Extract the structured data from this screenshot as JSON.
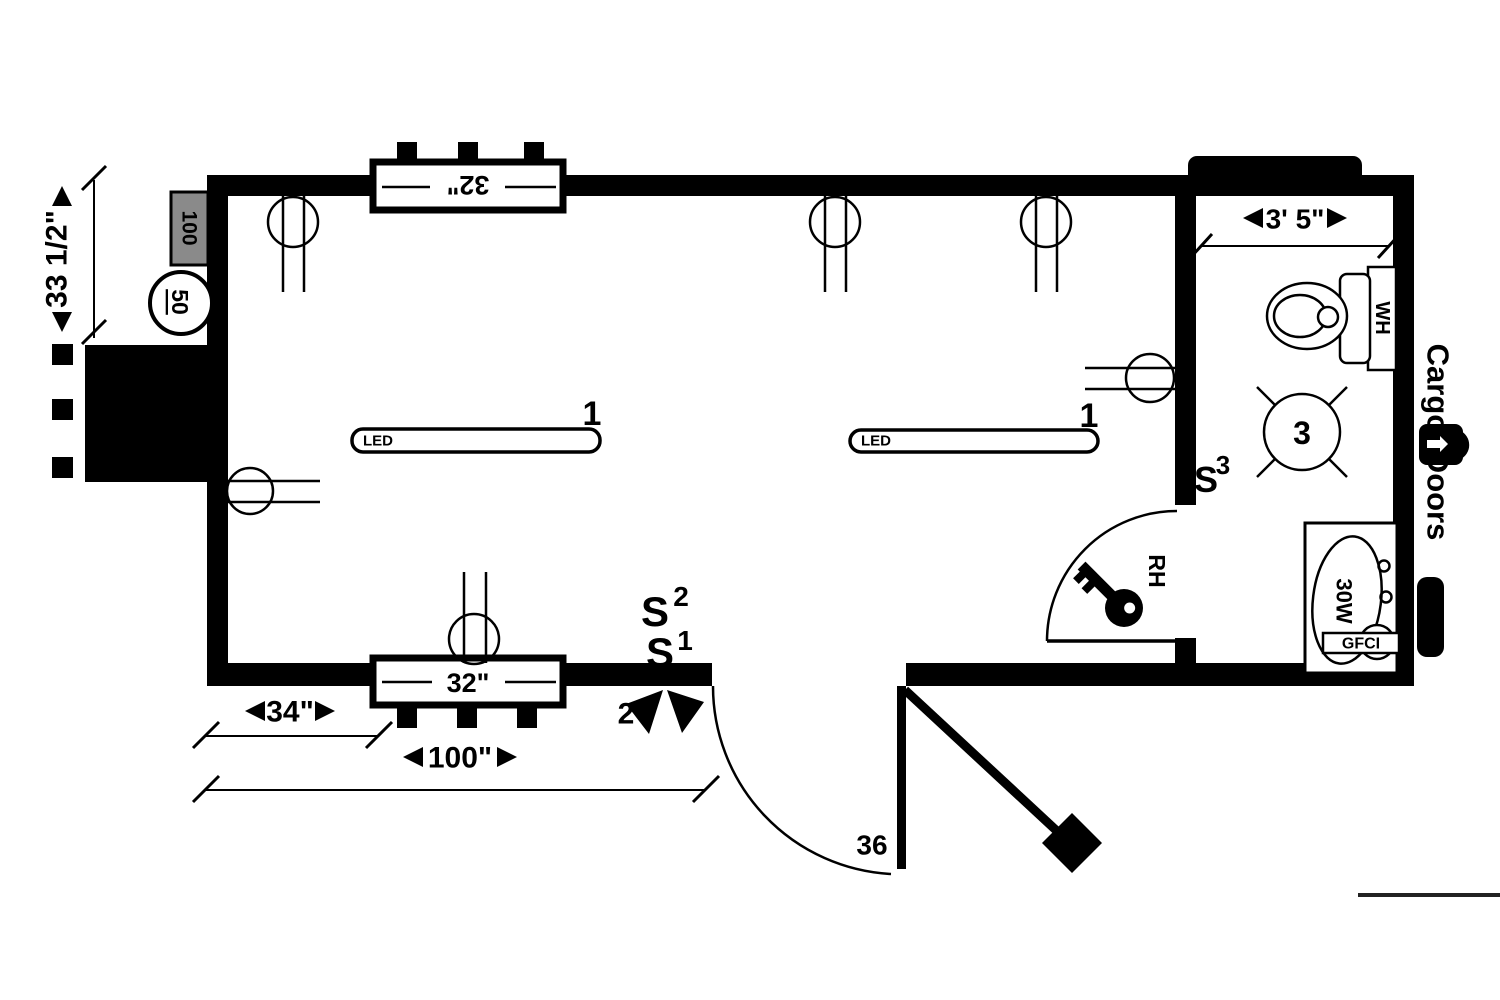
{
  "colors": {
    "ink": "#000000",
    "paper": "#ffffff",
    "panel_gray": "#8a8a8a"
  },
  "plan": {
    "left_side": {
      "height_dim": "33 1/2\"",
      "panel_label": "100",
      "outlet_label": "50",
      "ac_label": "A/C"
    },
    "windows": {
      "top_label": "32\"",
      "bottom_label": "32\""
    },
    "dimensions": {
      "window_offset": "34\"",
      "door_offset": "100\"",
      "bathroom_width": "3' 5\""
    },
    "lighting": {
      "led1": {
        "label": "LED",
        "circuit": "1"
      },
      "led2": {
        "label": "LED",
        "circuit": "1"
      },
      "exterior_circuit": "2"
    },
    "switches": {
      "base": "S",
      "s1": "1",
      "s2": "2",
      "s3": "3"
    },
    "doors": {
      "entry_width": "36",
      "bath_hand": "RH",
      "cargo_label": "Cargo Doors"
    },
    "bathroom": {
      "fan_circuit": "3",
      "water_heater": "WH",
      "vanity": "30W",
      "gfci": "GFCI"
    }
  }
}
